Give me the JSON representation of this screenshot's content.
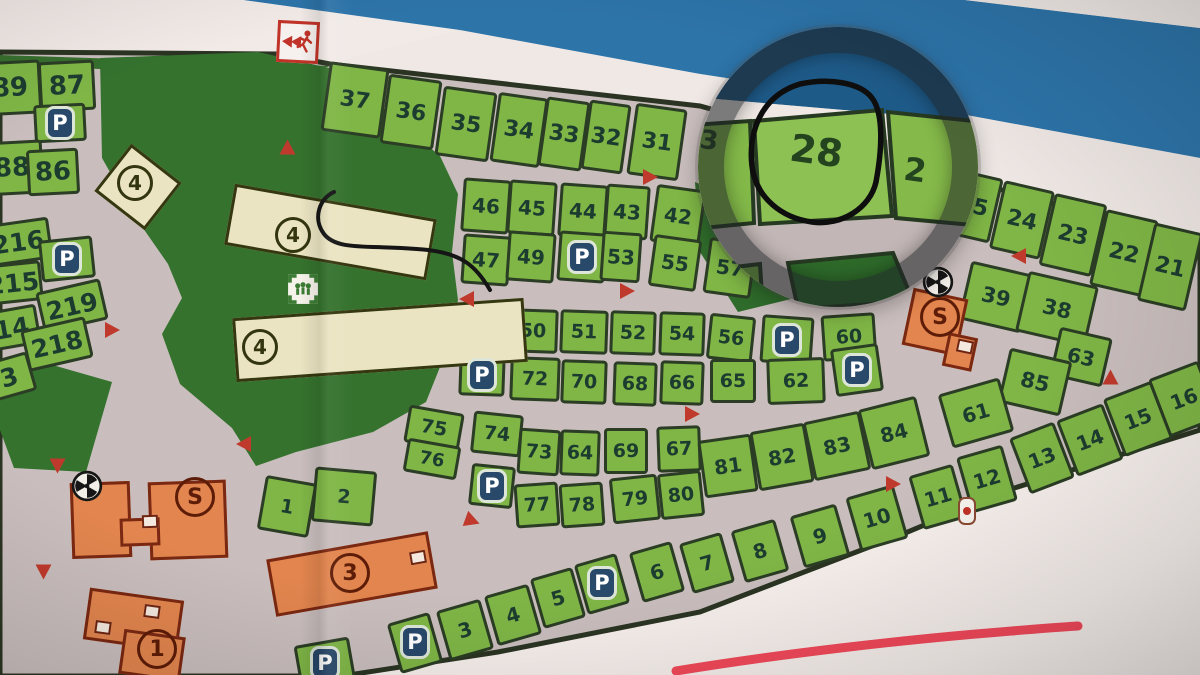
{
  "map": {
    "colors": {
      "paper": "#efe8e5",
      "stripe_blue": "#2d74a9",
      "road_gray": "#c9bebd",
      "plot_green": "#7fb646",
      "park_green": "#35722e",
      "outline": "#2b3d24",
      "cream_building": "#eae4c2",
      "orange_building": "#e2854e",
      "parking_blue": "#29496b",
      "arrow_red": "#bf3a2c",
      "marker_red": "#f2495a",
      "magnifier_ring": "#1e2024"
    },
    "p_label": "P",
    "magnifier": {
      "main_label": "28",
      "right_partial": "2",
      "left_partial": "3"
    },
    "plots": [
      {
        "t": "89",
        "x": 10,
        "y": 88,
        "w": 62,
        "h": 54,
        "a": -3,
        "fs": 26
      },
      {
        "t": "87",
        "x": 67,
        "y": 86,
        "w": 56,
        "h": 50,
        "a": -3,
        "fs": 26
      },
      {
        "t": "",
        "x": 60,
        "y": 123,
        "w": 52,
        "h": 38,
        "a": -3
      },
      {
        "t": "88",
        "x": 12,
        "y": 168,
        "w": 62,
        "h": 54,
        "a": -3,
        "fs": 26
      },
      {
        "t": "86",
        "x": 53,
        "y": 172,
        "w": 52,
        "h": 46,
        "a": -3,
        "fs": 26
      },
      {
        "t": "216",
        "x": 18,
        "y": 242,
        "w": 66,
        "h": 42,
        "a": -8,
        "fs": 25
      },
      {
        "t": "",
        "x": 67,
        "y": 259,
        "w": 54,
        "h": 42,
        "a": -6
      },
      {
        "t": "215",
        "x": 13,
        "y": 283,
        "w": 58,
        "h": 40,
        "a": -6,
        "fs": 25
      },
      {
        "t": "219",
        "x": 72,
        "y": 306,
        "w": 66,
        "h": 42,
        "a": -13,
        "fs": 25
      },
      {
        "t": "14",
        "x": 12,
        "y": 328,
        "w": 54,
        "h": 40,
        "a": -10,
        "fs": 25
      },
      {
        "t": "218",
        "x": 57,
        "y": 344,
        "w": 66,
        "h": 42,
        "a": -13,
        "fs": 25
      },
      {
        "t": "3",
        "x": 9,
        "y": 377,
        "w": 48,
        "h": 40,
        "a": -16,
        "fs": 25
      },
      {
        "t": "37",
        "x": 355,
        "y": 100,
        "w": 60,
        "h": 70,
        "a": 8,
        "fs": 22
      },
      {
        "t": "36",
        "x": 411,
        "y": 112,
        "w": 54,
        "h": 70,
        "a": 8,
        "fs": 22
      },
      {
        "t": "35",
        "x": 466,
        "y": 124,
        "w": 54,
        "h": 70,
        "a": 8,
        "fs": 22
      },
      {
        "t": "34",
        "x": 519,
        "y": 130,
        "w": 50,
        "h": 70,
        "a": 8,
        "fs": 22
      },
      {
        "t": "33",
        "x": 564,
        "y": 134,
        "w": 44,
        "h": 70,
        "a": 8,
        "fs": 22
      },
      {
        "t": "32",
        "x": 606,
        "y": 137,
        "w": 42,
        "h": 70,
        "a": 8,
        "fs": 22
      },
      {
        "t": "31",
        "x": 657,
        "y": 142,
        "w": 52,
        "h": 72,
        "a": 8,
        "fs": 22
      },
      {
        "t": "25",
        "x": 973,
        "y": 206,
        "w": 48,
        "h": 66,
        "a": 13,
        "fs": 22
      },
      {
        "t": "24",
        "x": 1022,
        "y": 220,
        "w": 52,
        "h": 70,
        "a": 13,
        "fs": 22
      },
      {
        "t": "23",
        "x": 1073,
        "y": 235,
        "w": 54,
        "h": 74,
        "a": 13,
        "fs": 22
      },
      {
        "t": "22",
        "x": 1124,
        "y": 253,
        "w": 54,
        "h": 78,
        "a": 13,
        "fs": 22
      },
      {
        "t": "21",
        "x": 1170,
        "y": 267,
        "w": 50,
        "h": 80,
        "a": 13,
        "fs": 22
      },
      {
        "t": "39",
        "x": 996,
        "y": 297,
        "w": 64,
        "h": 60,
        "a": 13,
        "fs": 21
      },
      {
        "t": "38",
        "x": 1057,
        "y": 309,
        "w": 72,
        "h": 62,
        "a": 13,
        "fs": 21
      },
      {
        "t": "63",
        "x": 1081,
        "y": 357,
        "w": 54,
        "h": 50,
        "a": 13,
        "fs": 20
      },
      {
        "t": "85",
        "x": 1035,
        "y": 382,
        "w": 64,
        "h": 56,
        "a": 13,
        "fs": 21
      },
      {
        "t": "16",
        "x": 1184,
        "y": 399,
        "w": 54,
        "h": 62,
        "a": -21,
        "fs": 20
      },
      {
        "t": "15",
        "x": 1138,
        "y": 419,
        "w": 52,
        "h": 62,
        "a": -21,
        "fs": 20
      },
      {
        "t": "14",
        "x": 1090,
        "y": 440,
        "w": 50,
        "h": 60,
        "a": -21,
        "fs": 20
      },
      {
        "t": "13",
        "x": 1042,
        "y": 458,
        "w": 48,
        "h": 60,
        "a": -21,
        "fs": 20
      },
      {
        "t": "12",
        "x": 987,
        "y": 479,
        "w": 48,
        "h": 58,
        "a": -16,
        "fs": 20
      },
      {
        "t": "11",
        "x": 938,
        "y": 497,
        "w": 46,
        "h": 56,
        "a": -16,
        "fs": 20
      },
      {
        "t": "10",
        "x": 877,
        "y": 518,
        "w": 50,
        "h": 56,
        "a": -16,
        "fs": 20
      },
      {
        "t": "9",
        "x": 820,
        "y": 536,
        "w": 48,
        "h": 54,
        "a": -16,
        "fs": 20
      },
      {
        "t": "8",
        "x": 760,
        "y": 551,
        "w": 46,
        "h": 54,
        "a": -16,
        "fs": 20
      },
      {
        "t": "7",
        "x": 707,
        "y": 563,
        "w": 44,
        "h": 52,
        "a": -16,
        "fs": 20
      },
      {
        "t": "6",
        "x": 657,
        "y": 572,
        "w": 44,
        "h": 52,
        "a": -16,
        "fs": 20
      },
      {
        "t": "",
        "x": 415,
        "y": 643,
        "w": 44,
        "h": 52,
        "a": -16
      },
      {
        "t": "3",
        "x": 465,
        "y": 630,
        "w": 46,
        "h": 52,
        "a": -16,
        "fs": 20
      },
      {
        "t": "4",
        "x": 513,
        "y": 615,
        "w": 46,
        "h": 52,
        "a": -16,
        "fs": 20
      },
      {
        "t": "5",
        "x": 558,
        "y": 598,
        "w": 44,
        "h": 52,
        "a": -16,
        "fs": 20
      },
      {
        "t": "",
        "x": 602,
        "y": 584,
        "w": 44,
        "h": 52,
        "a": -16
      },
      {
        "t": "",
        "x": 325,
        "y": 664,
        "w": 56,
        "h": 46,
        "a": -10
      },
      {
        "t": "46",
        "x": 486,
        "y": 206,
        "w": 48,
        "h": 54,
        "a": 4,
        "fs": 20
      },
      {
        "t": "45",
        "x": 532,
        "y": 208,
        "w": 48,
        "h": 54,
        "a": 4,
        "fs": 20
      },
      {
        "t": "44",
        "x": 583,
        "y": 211,
        "w": 48,
        "h": 54,
        "a": 4,
        "fs": 20
      },
      {
        "t": "43",
        "x": 627,
        "y": 212,
        "w": 44,
        "h": 54,
        "a": 4,
        "fs": 20
      },
      {
        "t": "42",
        "x": 678,
        "y": 216,
        "w": 50,
        "h": 58,
        "a": 8,
        "fs": 20
      },
      {
        "t": "47",
        "x": 486,
        "y": 260,
        "w": 48,
        "h": 50,
        "a": 4,
        "fs": 20
      },
      {
        "t": "49",
        "x": 531,
        "y": 257,
        "w": 48,
        "h": 50,
        "a": 4,
        "fs": 20
      },
      {
        "t": "",
        "x": 582,
        "y": 257,
        "w": 48,
        "h": 50,
        "a": 4
      },
      {
        "t": "53",
        "x": 621,
        "y": 257,
        "w": 40,
        "h": 50,
        "a": 4,
        "fs": 20
      },
      {
        "t": "55",
        "x": 675,
        "y": 263,
        "w": 48,
        "h": 52,
        "a": 8,
        "fs": 20
      },
      {
        "t": "57",
        "x": 730,
        "y": 268,
        "w": 48,
        "h": 56,
        "a": 8,
        "fs": 20
      },
      {
        "t": "48",
        "x": 483,
        "y": 333,
        "w": 46,
        "h": 44,
        "a": 2,
        "fs": 19
      },
      {
        "t": "50",
        "x": 533,
        "y": 331,
        "w": 50,
        "h": 44,
        "a": 2,
        "fs": 19
      },
      {
        "t": "51",
        "x": 584,
        "y": 332,
        "w": 48,
        "h": 44,
        "a": 2,
        "fs": 19
      },
      {
        "t": "52",
        "x": 633,
        "y": 333,
        "w": 46,
        "h": 44,
        "a": 2,
        "fs": 19
      },
      {
        "t": "54",
        "x": 682,
        "y": 334,
        "w": 46,
        "h": 44,
        "a": 2,
        "fs": 19
      },
      {
        "t": "56",
        "x": 731,
        "y": 338,
        "w": 46,
        "h": 46,
        "a": 6,
        "fs": 19
      },
      {
        "t": "",
        "x": 787,
        "y": 340,
        "w": 52,
        "h": 48,
        "a": 4
      },
      {
        "t": "60",
        "x": 849,
        "y": 337,
        "w": 54,
        "h": 46,
        "a": -4,
        "fs": 19
      },
      {
        "t": "",
        "x": 482,
        "y": 375,
        "w": 46,
        "h": 42,
        "a": 2
      },
      {
        "t": "72",
        "x": 535,
        "y": 379,
        "w": 50,
        "h": 44,
        "a": 2,
        "fs": 19
      },
      {
        "t": "70",
        "x": 584,
        "y": 382,
        "w": 46,
        "h": 44,
        "a": 2,
        "fs": 19
      },
      {
        "t": "68",
        "x": 635,
        "y": 384,
        "w": 44,
        "h": 44,
        "a": 2,
        "fs": 19
      },
      {
        "t": "66",
        "x": 682,
        "y": 383,
        "w": 44,
        "h": 44,
        "a": 2,
        "fs": 19
      },
      {
        "t": "65",
        "x": 733,
        "y": 381,
        "w": 46,
        "h": 44,
        "a": 0,
        "fs": 19
      },
      {
        "t": "62",
        "x": 796,
        "y": 381,
        "w": 58,
        "h": 46,
        "a": -2,
        "fs": 19
      },
      {
        "t": "",
        "x": 857,
        "y": 370,
        "w": 48,
        "h": 48,
        "a": -8
      },
      {
        "t": "75",
        "x": 434,
        "y": 428,
        "w": 56,
        "h": 38,
        "a": 10,
        "fs": 19
      },
      {
        "t": "74",
        "x": 497,
        "y": 434,
        "w": 50,
        "h": 42,
        "a": 6,
        "fs": 19
      },
      {
        "t": "73",
        "x": 539,
        "y": 452,
        "w": 42,
        "h": 46,
        "a": 4,
        "fs": 19
      },
      {
        "t": "64",
        "x": 580,
        "y": 453,
        "w": 40,
        "h": 46,
        "a": 2,
        "fs": 19
      },
      {
        "t": "69",
        "x": 626,
        "y": 451,
        "w": 44,
        "h": 46,
        "a": 0,
        "fs": 19
      },
      {
        "t": "67",
        "x": 679,
        "y": 449,
        "w": 44,
        "h": 46,
        "a": -2,
        "fs": 19
      },
      {
        "t": "81",
        "x": 728,
        "y": 466,
        "w": 54,
        "h": 58,
        "a": -8,
        "fs": 20
      },
      {
        "t": "82",
        "x": 782,
        "y": 457,
        "w": 56,
        "h": 60,
        "a": -10,
        "fs": 20
      },
      {
        "t": "83",
        "x": 837,
        "y": 446,
        "w": 58,
        "h": 60,
        "a": -12,
        "fs": 20
      },
      {
        "t": "84",
        "x": 894,
        "y": 433,
        "w": 60,
        "h": 62,
        "a": -14,
        "fs": 20
      },
      {
        "t": "61",
        "x": 976,
        "y": 413,
        "w": 64,
        "h": 56,
        "a": -16,
        "fs": 20
      },
      {
        "t": "76",
        "x": 432,
        "y": 459,
        "w": 54,
        "h": 34,
        "a": 10,
        "fs": 18
      },
      {
        "t": "",
        "x": 492,
        "y": 486,
        "w": 44,
        "h": 42,
        "a": 6
      },
      {
        "t": "77",
        "x": 537,
        "y": 505,
        "w": 44,
        "h": 44,
        "a": -4,
        "fs": 19
      },
      {
        "t": "78",
        "x": 582,
        "y": 505,
        "w": 44,
        "h": 44,
        "a": -4,
        "fs": 19
      },
      {
        "t": "79",
        "x": 635,
        "y": 499,
        "w": 48,
        "h": 46,
        "a": -6,
        "fs": 19
      },
      {
        "t": "80",
        "x": 681,
        "y": 495,
        "w": 44,
        "h": 46,
        "a": -6,
        "fs": 19
      },
      {
        "t": "1",
        "x": 287,
        "y": 506,
        "w": 52,
        "h": 55,
        "a": 10,
        "fs": 19
      },
      {
        "t": "2",
        "x": 344,
        "y": 496,
        "w": 62,
        "h": 55,
        "a": 5,
        "fs": 19
      }
    ],
    "p_icons": [
      [
        60,
        123
      ],
      [
        67,
        259
      ],
      [
        582,
        257
      ],
      [
        787,
        340
      ],
      [
        857,
        370
      ],
      [
        482,
        375
      ],
      [
        492,
        486
      ],
      [
        602,
        583
      ],
      [
        415,
        642
      ],
      [
        325,
        663
      ]
    ],
    "arrows": [
      [
        287,
        147,
        -90
      ],
      [
        650,
        177,
        0
      ],
      [
        112,
        330,
        0
      ],
      [
        466,
        299,
        180
      ],
      [
        627,
        291,
        0
      ],
      [
        692,
        414,
        0
      ],
      [
        472,
        521,
        20
      ],
      [
        243,
        444,
        180
      ],
      [
        57,
        466,
        90
      ],
      [
        43,
        572,
        90
      ],
      [
        1018,
        256,
        180
      ],
      [
        1110,
        377,
        -90
      ],
      [
        893,
        484,
        0
      ]
    ],
    "buildings": [
      {
        "k": "cream",
        "x": 138,
        "y": 187,
        "w": 64,
        "h": 60,
        "a": 38
      },
      {
        "k": "cream",
        "x": 330,
        "y": 232,
        "w": 205,
        "h": 62,
        "a": 10
      },
      {
        "k": "cream",
        "x": 380,
        "y": 340,
        "w": 292,
        "h": 64,
        "a": -4
      },
      {
        "k": "orange",
        "x": 101,
        "y": 520,
        "w": 60,
        "h": 76,
        "a": -2
      },
      {
        "k": "orange",
        "x": 188,
        "y": 520,
        "w": 78,
        "h": 78,
        "a": -2
      },
      {
        "k": "orange",
        "x": 140,
        "y": 532,
        "w": 40,
        "h": 28,
        "a": -2
      },
      {
        "k": "orange",
        "x": 352,
        "y": 574,
        "w": 164,
        "h": 58,
        "a": -10
      },
      {
        "k": "orange",
        "x": 935,
        "y": 322,
        "w": 56,
        "h": 58,
        "a": 12
      },
      {
        "k": "orange",
        "x": 960,
        "y": 352,
        "w": 30,
        "h": 34,
        "a": 12
      },
      {
        "k": "orange",
        "x": 133,
        "y": 620,
        "w": 95,
        "h": 52,
        "a": 8
      },
      {
        "k": "orange",
        "x": 152,
        "y": 655,
        "w": 62,
        "h": 45,
        "a": 8
      }
    ],
    "building_labels": [
      {
        "t": "4",
        "k": "cream",
        "x": 135,
        "y": 183
      },
      {
        "t": "4",
        "k": "cream",
        "x": 293,
        "y": 235
      },
      {
        "t": "4",
        "k": "cream",
        "x": 260,
        "y": 347
      },
      {
        "t": "S",
        "k": "orange",
        "x": 195,
        "y": 497
      },
      {
        "t": "3",
        "k": "orange",
        "x": 350,
        "y": 573
      },
      {
        "t": "S",
        "k": "orange",
        "x": 940,
        "y": 317
      },
      {
        "t": "1",
        "k": "orange",
        "x": 157,
        "y": 649
      }
    ],
    "doors": [
      [
        150,
        521,
        -2
      ],
      [
        418,
        557,
        -10
      ],
      [
        965,
        346,
        12
      ],
      [
        152,
        611,
        8
      ],
      [
        103,
        627,
        8
      ]
    ],
    "fan_icons": [
      [
        87,
        486
      ],
      [
        938,
        282
      ]
    ],
    "playground_icon": [
      303,
      289
    ],
    "gate_icon": [
      967,
      511
    ],
    "exit_sign": [
      298,
      42
    ]
  }
}
